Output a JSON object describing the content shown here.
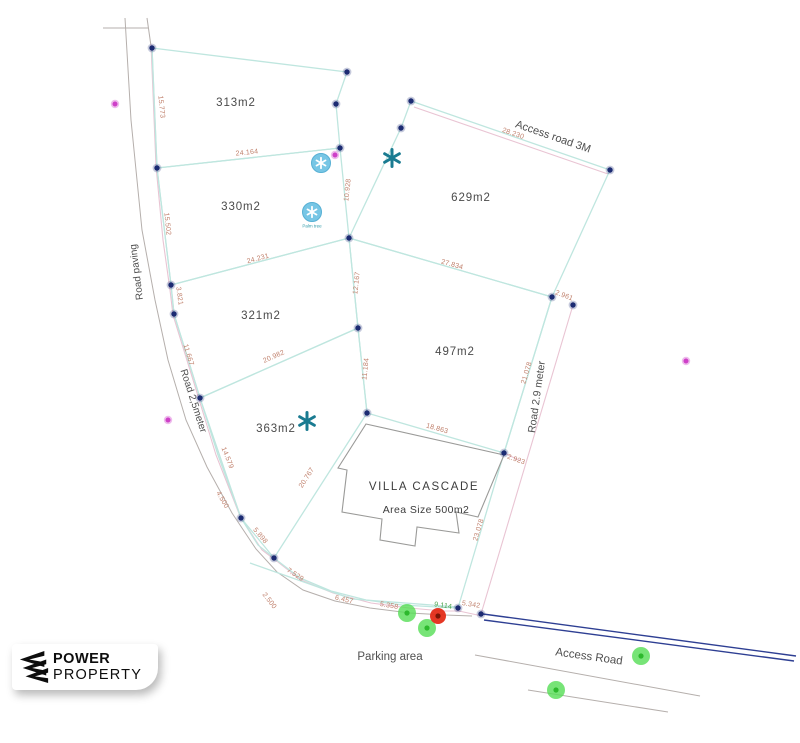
{
  "canvas": {
    "width": 800,
    "height": 743
  },
  "colors": {
    "parcel_line": "#bfe6df",
    "boundary_line": "#e9c4d3",
    "dim_text": "#c0806c",
    "dim_text_alt": "#4aa34a",
    "road_line": "#b5afac",
    "node": "#1c2b72",
    "access_road_line": "#2e3f93",
    "label_text": "#4a4a4a",
    "tree_star": "#1a7b91",
    "tree_circle": "#77c6e5",
    "magenta_dot": "#ce40c8",
    "green_dot": "#55dd55",
    "red_dot": "#e42c18",
    "villa_outline": "#9a9a98"
  },
  "parcels": [
    {
      "label": "313m2",
      "label_x": 236,
      "label_y": 103,
      "points": [
        [
          152,
          48
        ],
        [
          347,
          72
        ],
        [
          336,
          104
        ],
        [
          340,
          148
        ],
        [
          157,
          168
        ]
      ]
    },
    {
      "label": "330m2",
      "label_x": 241,
      "label_y": 207,
      "points": [
        [
          157,
          168
        ],
        [
          340,
          148
        ],
        [
          349,
          238
        ],
        [
          171,
          285
        ]
      ]
    },
    {
      "label": "629m2",
      "label_x": 471,
      "label_y": 198,
      "points": [
        [
          411,
          101
        ],
        [
          610,
          170
        ],
        [
          552,
          297
        ],
        [
          349,
          238
        ],
        [
          401,
          128
        ]
      ]
    },
    {
      "label": "321m2",
      "label_x": 261,
      "label_y": 316,
      "points": [
        [
          171,
          285
        ],
        [
          349,
          238
        ],
        [
          358,
          328
        ],
        [
          200,
          398
        ],
        [
          174,
          314
        ]
      ]
    },
    {
      "label": "497m2",
      "label_x": 455,
      "label_y": 352,
      "points": [
        [
          349,
          238
        ],
        [
          552,
          297
        ],
        [
          504,
          453
        ],
        [
          367,
          413
        ],
        [
          358,
          328
        ]
      ]
    },
    {
      "label": "363m2",
      "label_x": 276,
      "label_y": 429,
      "points": [
        [
          200,
          398
        ],
        [
          358,
          328
        ],
        [
          367,
          413
        ],
        [
          274,
          558
        ],
        [
          241,
          518
        ]
      ]
    }
  ],
  "villa": {
    "name": "VILLA CASCADE",
    "area_label": "Area Size 500m2",
    "name_x": 424,
    "name_y": 487,
    "area_x": 426,
    "area_y": 510,
    "outline": [
      [
        366,
        424
      ],
      [
        504,
        455
      ],
      [
        478,
        517
      ],
      [
        456,
        512
      ],
      [
        459,
        533
      ],
      [
        417,
        527
      ],
      [
        415,
        546
      ],
      [
        380,
        540
      ],
      [
        382,
        519
      ],
      [
        342,
        512
      ],
      [
        347,
        470
      ],
      [
        338,
        468
      ]
    ]
  },
  "road_labels": [
    {
      "text": "Road paving",
      "x": 137,
      "y": 272,
      "rot": -97,
      "size": 10
    },
    {
      "text": "Road 2,5meter",
      "x": 193,
      "y": 401,
      "rot": 72,
      "size": 10
    },
    {
      "text": "Road  2.9 meter",
      "x": 537,
      "y": 397,
      "rot": -82,
      "size": 10.5
    },
    {
      "text": "Access road 3M",
      "x": 553,
      "y": 137,
      "rot": 19,
      "size": 11
    },
    {
      "text": "Parking area",
      "x": 390,
      "y": 657,
      "rot": 0,
      "size": 11.5
    },
    {
      "text": "Access Road",
      "x": 589,
      "y": 657,
      "rot": 8,
      "size": 11.5
    }
  ],
  "dimensions": [
    {
      "text": "15.773",
      "x": 161,
      "y": 107,
      "rot": 84
    },
    {
      "text": "15.502",
      "x": 167,
      "y": 224,
      "rot": 84
    },
    {
      "text": "3.821",
      "x": 179,
      "y": 296,
      "rot": 82
    },
    {
      "text": "11.667",
      "x": 188,
      "y": 355,
      "rot": 73
    },
    {
      "text": "14.579",
      "x": 227,
      "y": 458,
      "rot": 68
    },
    {
      "text": "4.500",
      "x": 222,
      "y": 500,
      "rot": 60
    },
    {
      "text": "5.898",
      "x": 260,
      "y": 536,
      "rot": 50
    },
    {
      "text": "7.529",
      "x": 295,
      "y": 575,
      "rot": 33
    },
    {
      "text": "2.500",
      "x": 269,
      "y": 601,
      "rot": 52
    },
    {
      "text": "6.457",
      "x": 344,
      "y": 600,
      "rot": 13
    },
    {
      "text": "5.358",
      "x": 389,
      "y": 606,
      "rot": 10
    },
    {
      "text": "9.114",
      "x": 443,
      "y": 606,
      "rot": 9,
      "color_key": "dim_text_alt"
    },
    {
      "text": "5.342",
      "x": 471,
      "y": 605,
      "rot": 9
    },
    {
      "text": "24.164",
      "x": 247,
      "y": 153,
      "rot": -6
    },
    {
      "text": "24.231",
      "x": 258,
      "y": 259,
      "rot": -15
    },
    {
      "text": "20.982",
      "x": 274,
      "y": 357,
      "rot": -24
    },
    {
      "text": "20.767",
      "x": 307,
      "y": 478,
      "rot": -57
    },
    {
      "text": "10.928",
      "x": 348,
      "y": 190,
      "rot": -84
    },
    {
      "text": "12.167",
      "x": 357,
      "y": 283,
      "rot": -84
    },
    {
      "text": "11.184",
      "x": 366,
      "y": 369,
      "rot": -84
    },
    {
      "text": "27.834",
      "x": 452,
      "y": 265,
      "rot": 16
    },
    {
      "text": "2.961",
      "x": 564,
      "y": 296,
      "rot": 21
    },
    {
      "text": "21.078",
      "x": 527,
      "y": 373,
      "rot": -73
    },
    {
      "text": "18.863",
      "x": 437,
      "y": 429,
      "rot": 16
    },
    {
      "text": "2.923",
      "x": 516,
      "y": 460,
      "rot": 20
    },
    {
      "text": "23.078",
      "x": 479,
      "y": 530,
      "rot": -73
    },
    {
      "text": "28.230",
      "x": 513,
      "y": 134,
      "rot": 19
    }
  ],
  "tree_label": {
    "text": "Palm tree",
    "x": 312,
    "y": 226
  },
  "geometry": {
    "road_gray_polylines": [
      [
        [
          125,
          18
        ],
        [
          131,
          120
        ],
        [
          142,
          230
        ],
        [
          155,
          300
        ],
        [
          168,
          360
        ],
        [
          186,
          420
        ],
        [
          207,
          467
        ],
        [
          232,
          513
        ],
        [
          256,
          549
        ],
        [
          277,
          572
        ],
        [
          303,
          590
        ],
        [
          335,
          601
        ],
        [
          370,
          608
        ],
        [
          410,
          613
        ],
        [
          445,
          615
        ],
        [
          472,
          616
        ]
      ],
      [
        [
          103,
          28
        ],
        [
          148,
          28
        ]
      ],
      [
        [
          147,
          18
        ],
        [
          151,
          46
        ]
      ],
      [
        [
          475,
          655
        ],
        [
          700,
          696
        ]
      ],
      [
        [
          528,
          690
        ],
        [
          668,
          712
        ]
      ]
    ],
    "pink_polylines": [
      [
        [
          151,
          44
        ],
        [
          156,
          166
        ],
        [
          163,
          240
        ],
        [
          170,
          290
        ],
        [
          173,
          315
        ],
        [
          198,
          396
        ],
        [
          216,
          455
        ],
        [
          240,
          516
        ],
        [
          262,
          550
        ],
        [
          278,
          562
        ],
        [
          301,
          580
        ],
        [
          333,
          593
        ],
        [
          371,
          603
        ],
        [
          409,
          608
        ],
        [
          443,
          611
        ],
        [
          459,
          611
        ],
        [
          482,
          616
        ]
      ],
      [
        [
          414,
          107
        ],
        [
          608,
          174
        ]
      ],
      [
        [
          573,
          305
        ],
        [
          481,
          614
        ]
      ],
      [
        [
          504,
          453
        ],
        [
          521,
          461
        ]
      ]
    ],
    "teal_polylines": [
      [
        [
          152,
          48
        ],
        [
          157,
          168
        ],
        [
          171,
          285
        ],
        [
          174,
          314
        ],
        [
          200,
          398
        ],
        [
          218,
          455
        ],
        [
          241,
          518
        ],
        [
          258,
          545
        ],
        [
          274,
          558
        ],
        [
          300,
          578
        ],
        [
          331,
          591
        ],
        [
          366,
          600
        ],
        [
          402,
          605
        ],
        [
          437,
          607
        ],
        [
          458,
          608
        ]
      ],
      [
        [
          552,
          297
        ],
        [
          504,
          453
        ],
        [
          458,
          608
        ]
      ],
      [
        [
          250,
          563
        ],
        [
          352,
          599
        ]
      ],
      [
        [
          352,
          599
        ],
        [
          458,
          607
        ]
      ]
    ],
    "access_road_lines": [
      [
        [
          483,
          614
        ],
        [
          796,
          656
        ]
      ],
      [
        [
          484,
          620
        ],
        [
          794,
          661
        ]
      ]
    ],
    "nodes": [
      [
        152,
        48
      ],
      [
        347,
        72
      ],
      [
        336,
        104
      ],
      [
        401,
        128
      ],
      [
        411,
        101
      ],
      [
        610,
        170
      ],
      [
        157,
        168
      ],
      [
        340,
        148
      ],
      [
        349,
        238
      ],
      [
        552,
        297
      ],
      [
        573,
        305
      ],
      [
        171,
        285
      ],
      [
        174,
        314
      ],
      [
        358,
        328
      ],
      [
        200,
        398
      ],
      [
        367,
        413
      ],
      [
        504,
        453
      ],
      [
        241,
        518
      ],
      [
        274,
        558
      ],
      [
        458,
        608
      ],
      [
        481,
        614
      ]
    ],
    "magenta_dots": [
      [
        115,
        104
      ],
      [
        168,
        420
      ],
      [
        335,
        155
      ],
      [
        686,
        361
      ]
    ],
    "green_dots": [
      [
        407,
        613
      ],
      [
        427,
        628
      ],
      [
        641,
        656
      ],
      [
        556,
        690
      ]
    ],
    "red_dot": [
      438,
      616
    ],
    "tree_stars": [
      [
        392,
        158
      ],
      [
        307,
        421
      ]
    ],
    "tree_circles": [
      [
        321,
        163
      ],
      [
        312,
        212
      ]
    ]
  },
  "logo": {
    "line1": "POWER",
    "line2": "PROPERTY"
  }
}
